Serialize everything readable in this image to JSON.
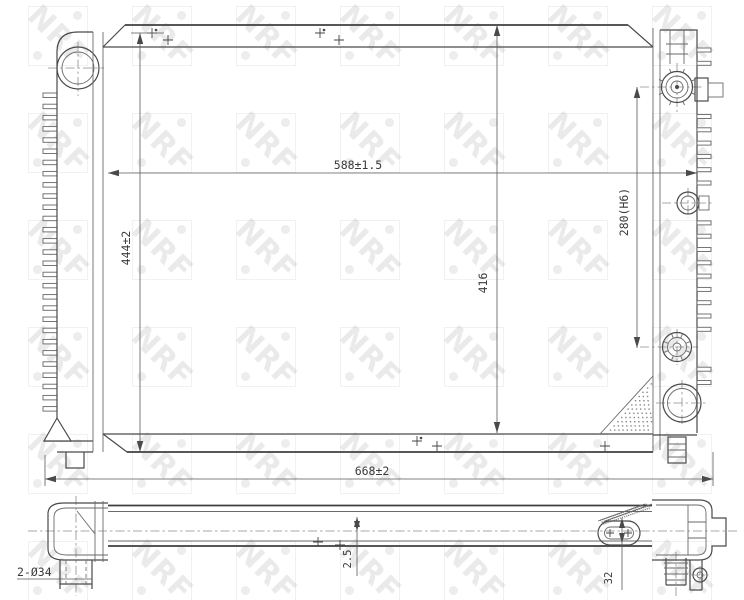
{
  "watermark": {
    "text": "NRF"
  },
  "drawing": {
    "title": "radiator-technical-drawing",
    "dimensions": {
      "top_width": "588±1.5",
      "left_height": "444±2",
      "core_height": "416",
      "port_spacing": "280(H6)",
      "overall_width": "668±2",
      "pipe_diameter": "2-Ø34",
      "core_offset": "2.5",
      "bracket_height": "32"
    },
    "colors": {
      "line": "#4a4a4a",
      "thin_line": "#6a6a6a",
      "centerline": "#8c8c8c",
      "text": "#3a3a3a",
      "watermark": "rgba(105,105,105,0.14)"
    }
  }
}
